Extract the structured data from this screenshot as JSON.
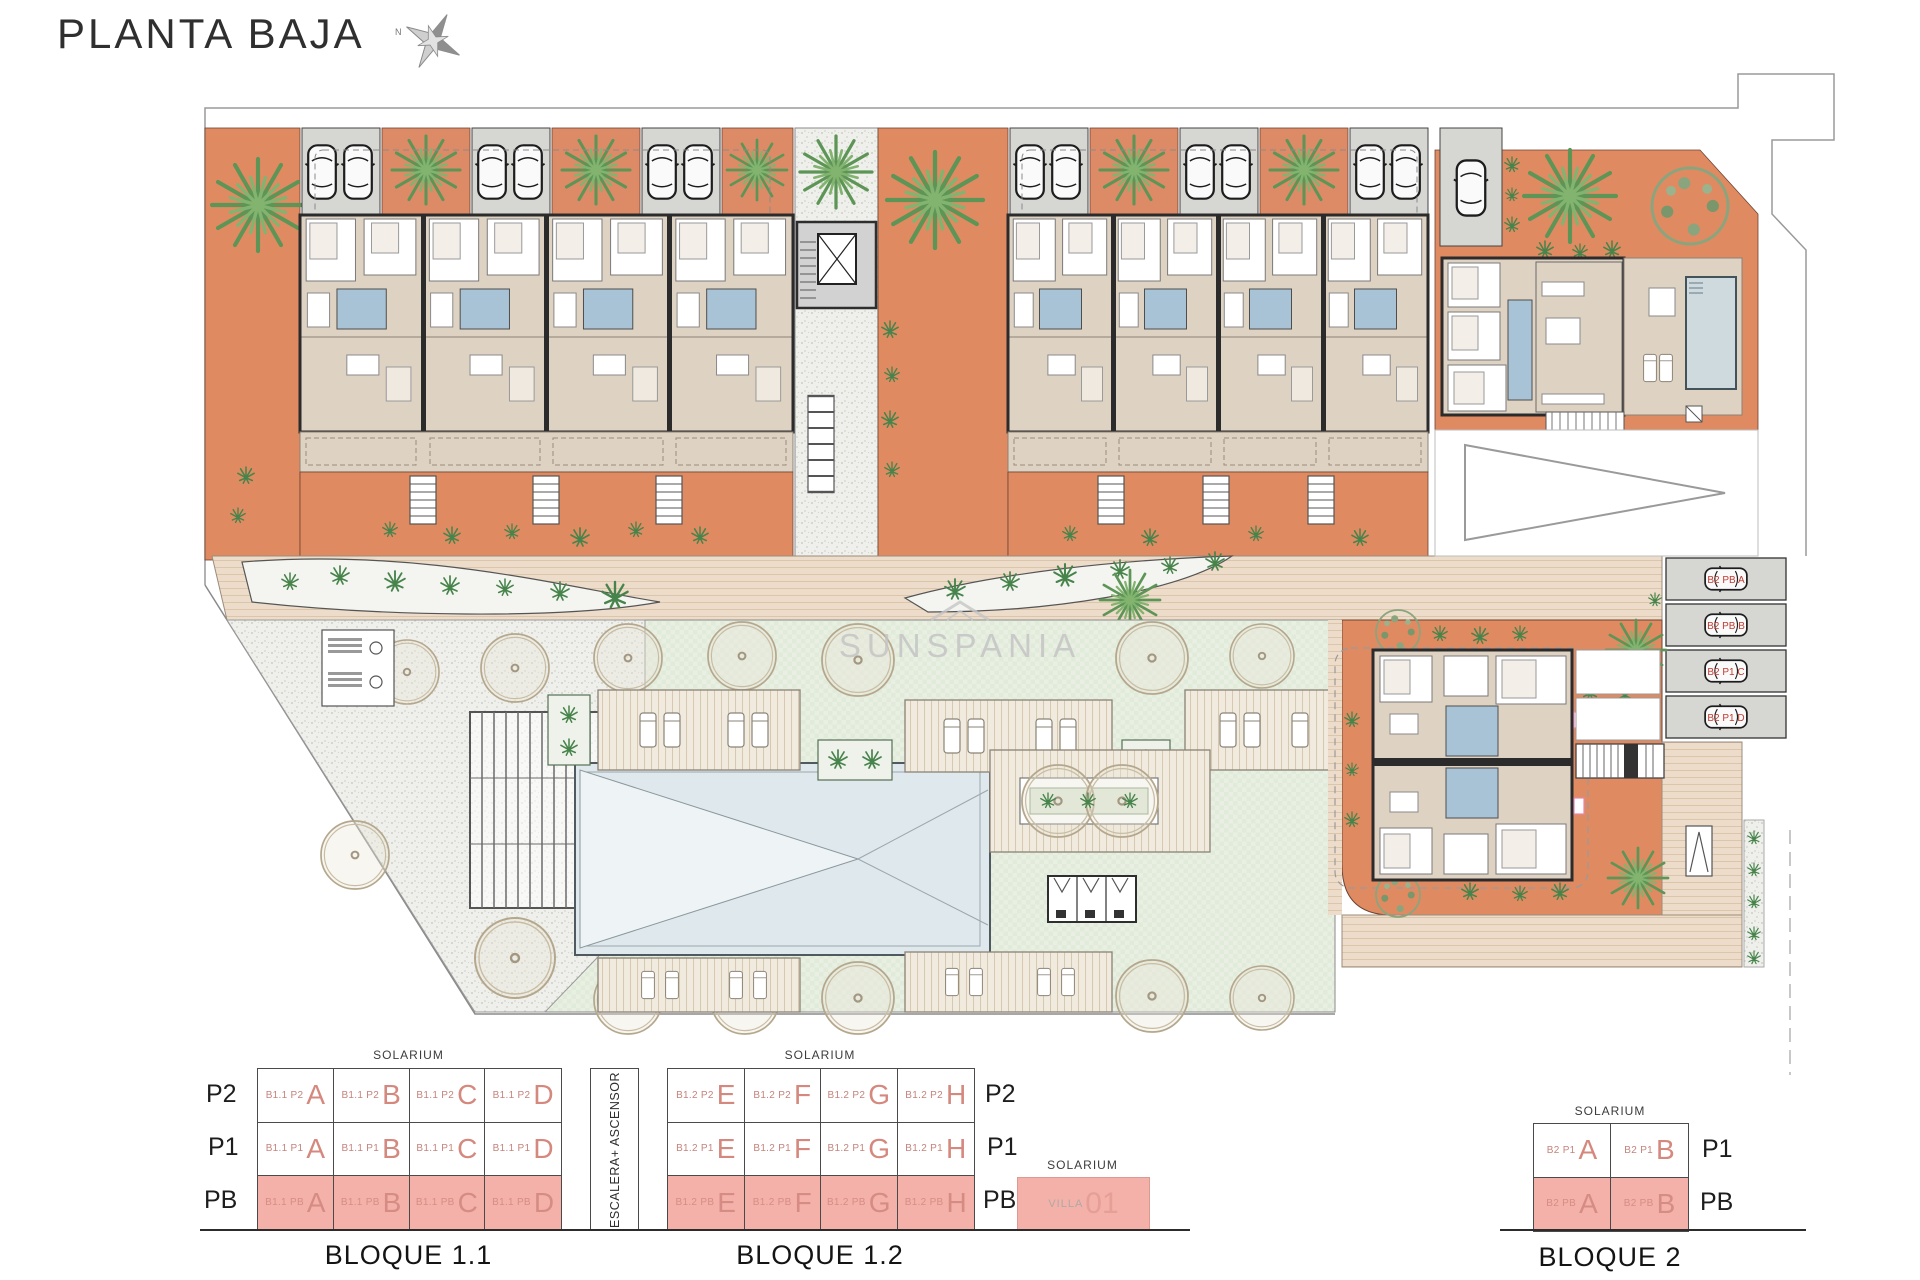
{
  "title": "PLANTA BAJA",
  "compass": {
    "north_label": "N"
  },
  "watermark": {
    "text": "SUNSPANIA"
  },
  "plan": {
    "parking_space_labels": [
      "B2 PB A",
      "B2 PB B",
      "B2 P1 C",
      "B2 P1 D"
    ],
    "colors": {
      "terrace_orange": "#e08a62",
      "floor_beige": "#ded2c3",
      "garage_grey": "#d6d6d3",
      "bath_blue": "#a9c3d6",
      "lawn_green": "#e9efe3",
      "pool_blue": "#dfe8ec",
      "walkway_tan": "#eddcc9",
      "legend_pink": "#f3b1a9",
      "unit_text_pink": "#d5887e",
      "parking_label_red": "#c23a31"
    }
  },
  "legend": {
    "bloque_1_1": {
      "name": "BLOQUE 1.1",
      "solarium_label": "SOLARIUM",
      "floor_labels": [
        "P2",
        "P1",
        "PB"
      ],
      "rows": [
        {
          "floor": "P2",
          "cells": [
            {
              "code": "B1.1 P2",
              "letter": "A"
            },
            {
              "code": "B1.1 P2",
              "letter": "B"
            },
            {
              "code": "B1.1 P2",
              "letter": "C"
            },
            {
              "code": "B1.1 P2",
              "letter": "D"
            }
          ]
        },
        {
          "floor": "P1",
          "cells": [
            {
              "code": "B1.1 P1",
              "letter": "A"
            },
            {
              "code": "B1.1 P1",
              "letter": "B"
            },
            {
              "code": "B1.1 P1",
              "letter": "C"
            },
            {
              "code": "B1.1 P1",
              "letter": "D"
            }
          ]
        },
        {
          "floor": "PB",
          "cells": [
            {
              "code": "B1.1 PB",
              "letter": "A"
            },
            {
              "code": "B1.1 PB",
              "letter": "B"
            },
            {
              "code": "B1.1 PB",
              "letter": "C"
            },
            {
              "code": "B1.1 PB",
              "letter": "D"
            }
          ]
        }
      ]
    },
    "escalera_label": "ESCALERA+ ASCENSOR",
    "bloque_1_2": {
      "name": "BLOQUE 1.2",
      "solarium_label": "SOLARIUM",
      "floor_labels": [
        "P2",
        "P1",
        "PB"
      ],
      "rows": [
        {
          "floor": "P2",
          "cells": [
            {
              "code": "B1.2 P2",
              "letter": "E"
            },
            {
              "code": "B1.2 P2",
              "letter": "F"
            },
            {
              "code": "B1.2 P2",
              "letter": "G"
            },
            {
              "code": "B1.2 P2",
              "letter": "H"
            }
          ]
        },
        {
          "floor": "P1",
          "cells": [
            {
              "code": "B1.2 P1",
              "letter": "E"
            },
            {
              "code": "B1.2 P1",
              "letter": "F"
            },
            {
              "code": "B1.2 P1",
              "letter": "G"
            },
            {
              "code": "B1.2 P1",
              "letter": "H"
            }
          ]
        },
        {
          "floor": "PB",
          "cells": [
            {
              "code": "B1.2 PB",
              "letter": "E"
            },
            {
              "code": "B1.2 PB",
              "letter": "F"
            },
            {
              "code": "B1.2 PB",
              "letter": "G"
            },
            {
              "code": "B1.2 PB",
              "letter": "H"
            }
          ]
        }
      ]
    },
    "villa": {
      "solarium_label": "SOLARIUM",
      "code": "VILLA",
      "number": "01"
    },
    "bloque_2": {
      "name": "BLOQUE 2",
      "solarium_label": "SOLARIUM",
      "floor_labels": [
        "P1",
        "PB"
      ],
      "rows": [
        {
          "floor": "P1",
          "cells": [
            {
              "code": "B2 P1",
              "letter": "A"
            },
            {
              "code": "B2 P1",
              "letter": "B"
            }
          ]
        },
        {
          "floor": "PB",
          "cells": [
            {
              "code": "B2 PB",
              "letter": "A"
            },
            {
              "code": "B2 PB",
              "letter": "B"
            }
          ]
        }
      ]
    }
  }
}
